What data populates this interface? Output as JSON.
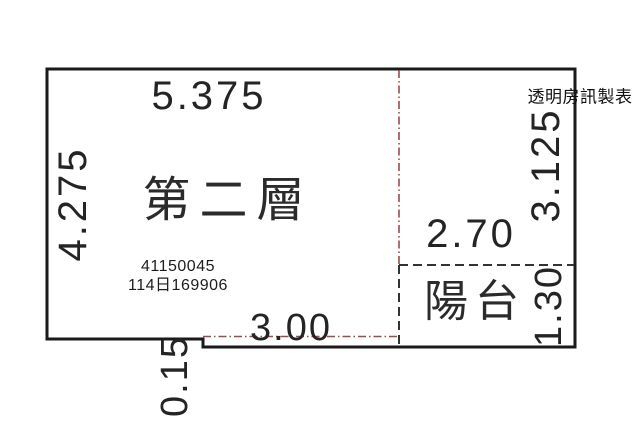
{
  "watermark": "透明房訊製表",
  "floor_plan": {
    "room_label": "第二層",
    "balcony_label": "陽台",
    "registration": {
      "line1": "41150045",
      "line2": "114日169906"
    },
    "dimensions": {
      "top_width": "5.375",
      "left_height": "4.275",
      "bottom_inner_width": "3.00",
      "step_depth": "0.15",
      "balcony_width": "2.70",
      "right_height": "3.125",
      "balcony_depth": "1.30"
    },
    "colors": {
      "outline": "#1a1a1a",
      "dashed": "#333333",
      "boundary_red": "#9c4a4f",
      "background": "#ffffff"
    }
  }
}
